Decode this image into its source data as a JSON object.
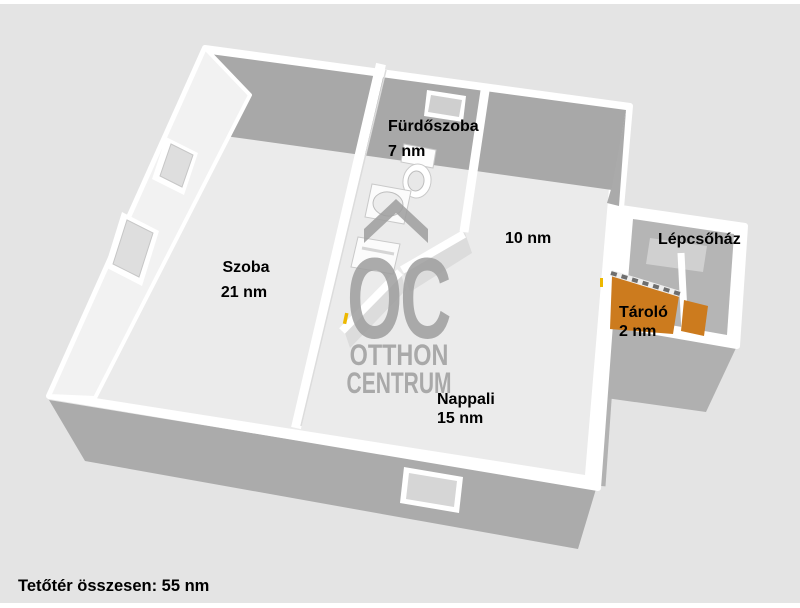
{
  "floorplan": {
    "rooms": [
      {
        "name": "Szoba",
        "area": "21 nm"
      },
      {
        "name": "Fürdőszoba",
        "area": "7 nm"
      },
      {
        "name": "",
        "area": "10 nm"
      },
      {
        "name": "Nappali",
        "area": "15 nm"
      },
      {
        "name": "Tároló",
        "area": "2 nm"
      },
      {
        "name": "Lépcsőház",
        "area": ""
      }
    ],
    "total": "Tetőtér összesen: 55 nm"
  },
  "watermark": {
    "monogram": "OC",
    "name_line1": "OTTHON",
    "name_line2": "CENTRUM"
  },
  "colors": {
    "background": "#e4e4e4",
    "wall_top": "#ffffff",
    "wall_dark": "#a8a8a8",
    "wall_mid": "#b0b0b0",
    "floor": "#ebebeb",
    "roof_plane": "#f2f2f2",
    "stair_floor": "#b5b5b5",
    "landing": "#d0d0d0",
    "stairs_accent": "#cc7b1e",
    "door_mark": "#edb800",
    "watermark": "#9e9e9e",
    "label_text": "#000000"
  }
}
